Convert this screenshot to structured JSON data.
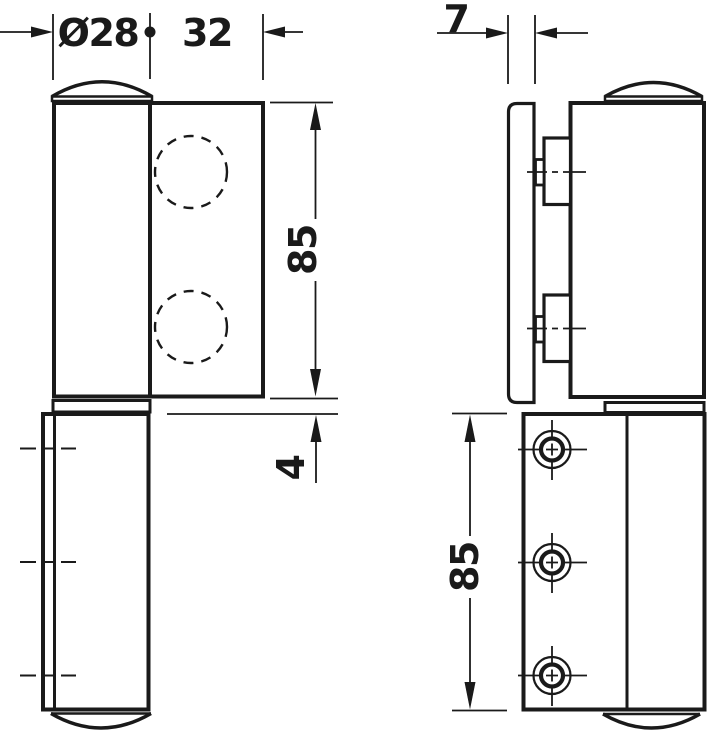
{
  "drawing": {
    "type": "technical-drawing-hinge-two-views",
    "background_color": "#ffffff",
    "line_color": "#1a1a1a",
    "dimensions": {
      "knuckle_diameter": {
        "label": "Ø28"
      },
      "leaf_width": {
        "label": "32"
      },
      "glass_thickness": {
        "label": "7"
      },
      "upper_leaf_height": {
        "label": "85"
      },
      "joint_gap": {
        "label": "4"
      },
      "lower_leaf_height": {
        "label": "85"
      }
    }
  }
}
